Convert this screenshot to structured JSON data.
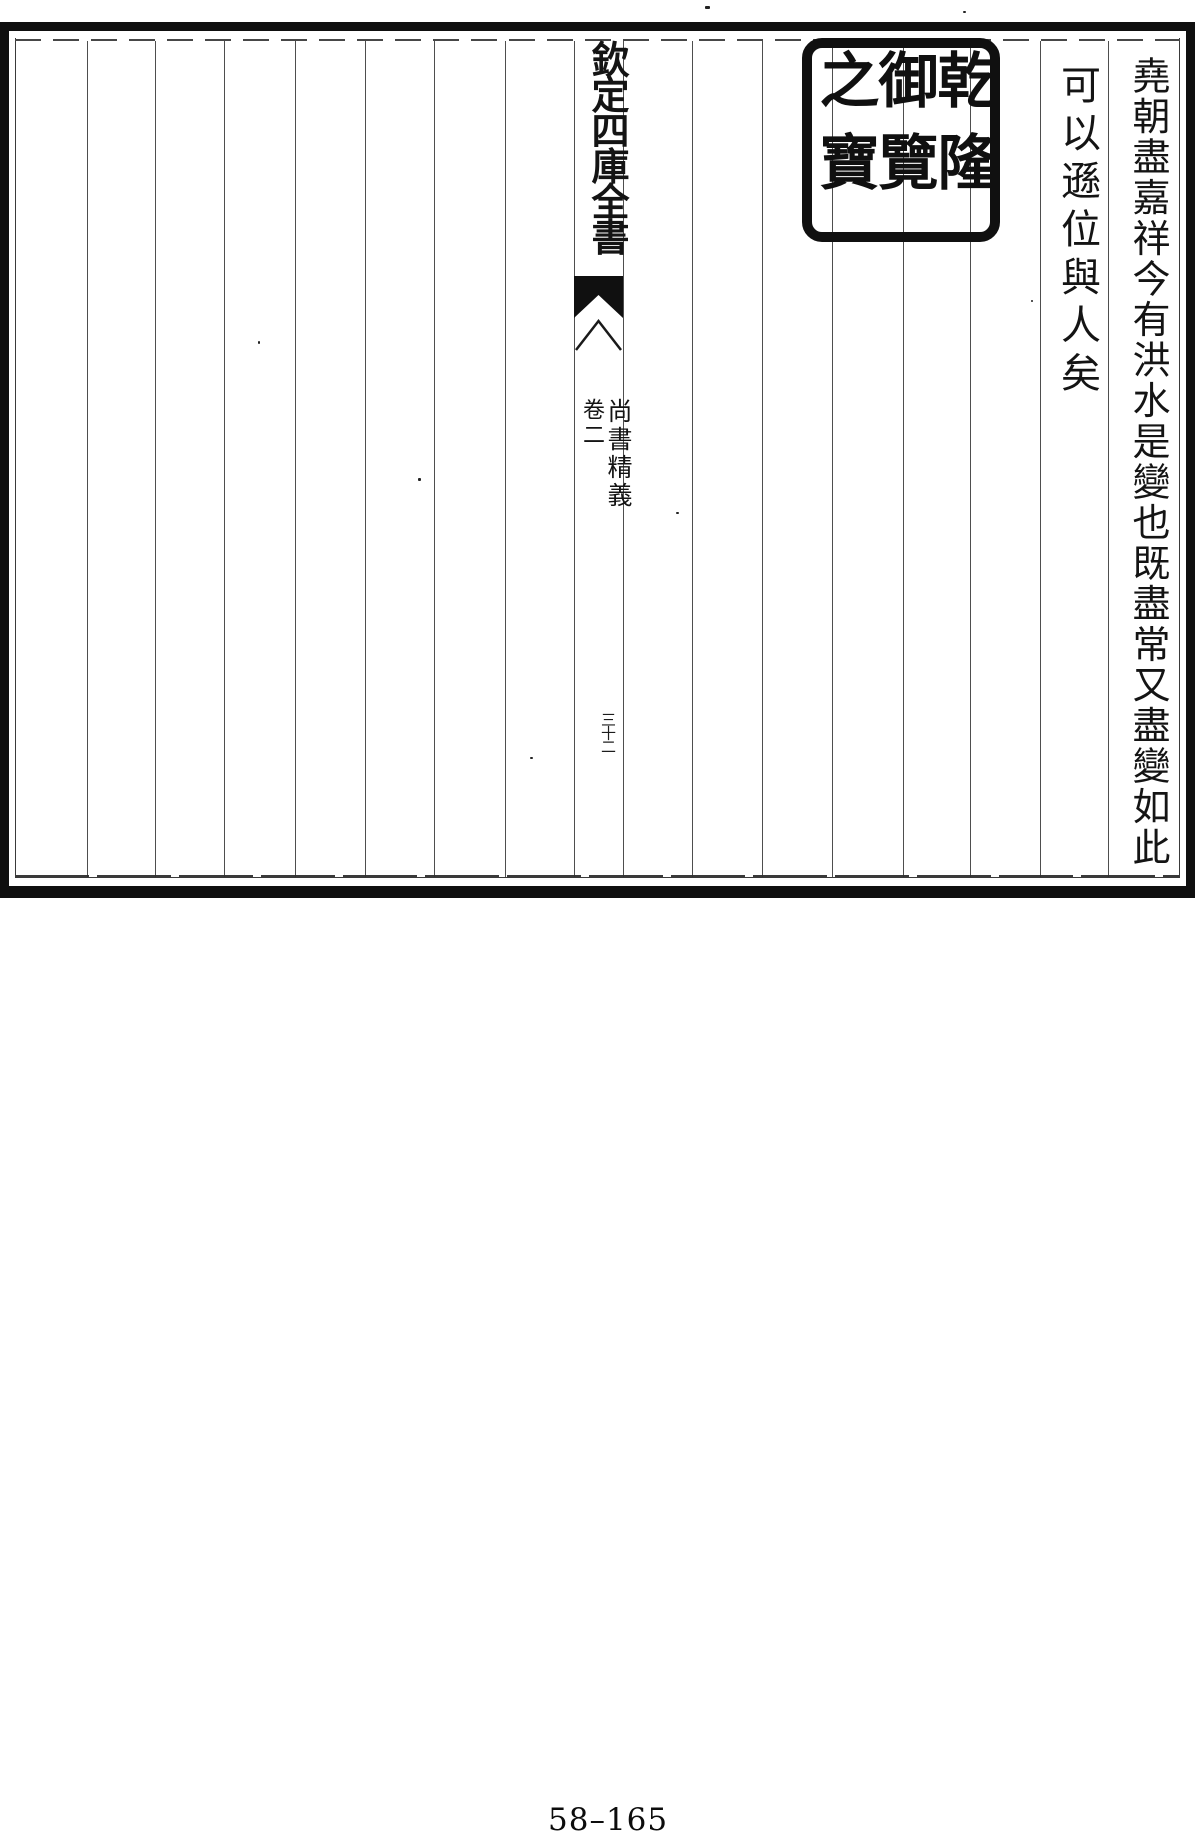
{
  "header": {
    "series_title": "欽定四庫全書"
  },
  "banxin": {
    "book_title": "尚書精義",
    "volume": "卷二",
    "folio": "三十二"
  },
  "seal": {
    "text": "乾隆御覽之寶"
  },
  "text_columns": [
    {
      "text": "堯朝盡嘉祥今有洪水是變也既盡常又盡變如此"
    },
    {
      "text": "可以遜位與人矣"
    }
  ],
  "footer": {
    "page_number": "58–165"
  },
  "colors": {
    "ink": "#141414",
    "paper": "#ffffff",
    "rule": "#3a3a3a",
    "border": "#0f0f0f"
  }
}
